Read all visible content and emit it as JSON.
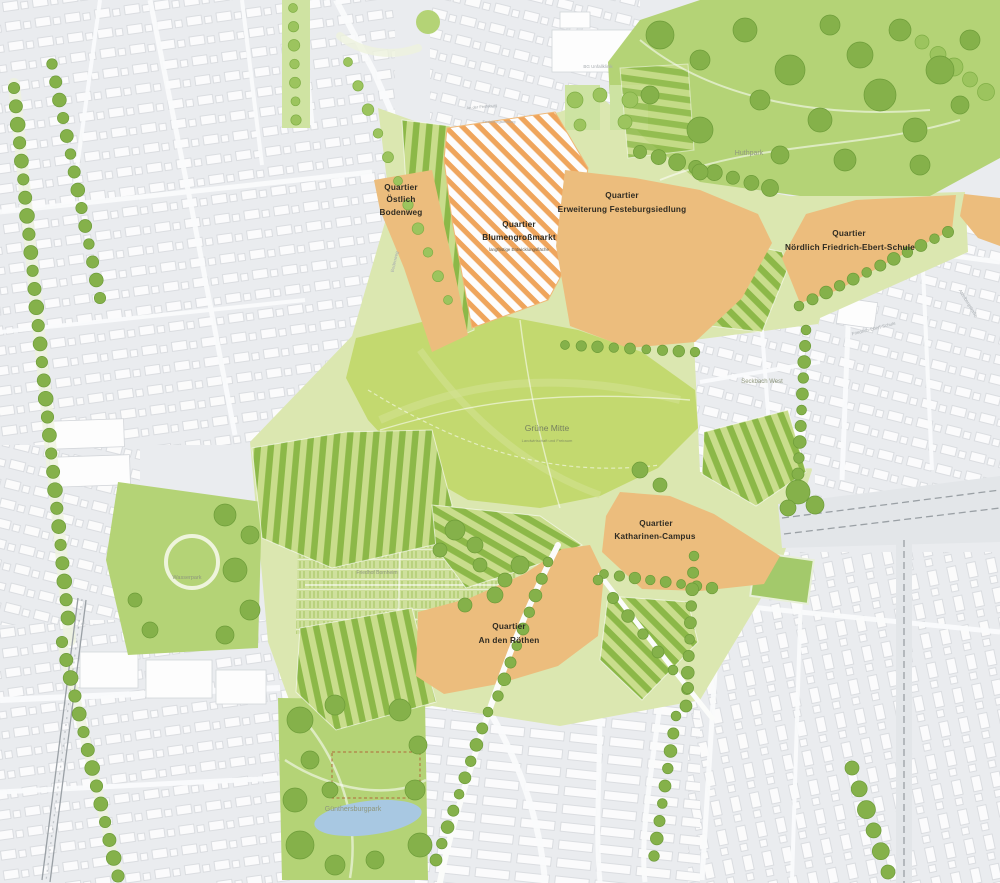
{
  "map": {
    "title": "Masterplan Grüne Mitte — Quartiersplan",
    "quarters": [
      {
        "id": "oestlich-bodenweg",
        "line1": "Quartier",
        "line2": "Östlich",
        "line3": "Bodenweg"
      },
      {
        "id": "blumengrossmarkt",
        "line1": "Quartier",
        "line2": "Blumengroßmarkt",
        "subtitle": "langfristige Entwicklungsfläche"
      },
      {
        "id": "erweiterung-festeburgsiedlung",
        "line1": "Quartier",
        "line2": "Erweiterung Festeburgsiedlung"
      },
      {
        "id": "noerdlich-friedrich-ebert-schule",
        "line1": "Quartier",
        "line2": "Nördlich Friedrich-Ebert-Schule"
      },
      {
        "id": "katharinen-campus",
        "line1": "Quartier",
        "line2": "Katharinen-Campus"
      },
      {
        "id": "an-den-roethen",
        "line1": "Quartier",
        "line2": "An den Röthen"
      }
    ],
    "places": {
      "huthpark": "Huthpark",
      "guenthersburgpark": "Günthersburgpark",
      "wasserpark": "Wasserpark",
      "friedhof": "Friedhof Bornheim",
      "gruene_mitte": "Grüne Mitte",
      "gruene_mitte_sub": "Landwirtschaft und Freiraum",
      "seckbach_west": "Seckbach West",
      "bg_unfallklinik": "BG Unfallklinik",
      "friedrich_ebert_schule": "Friedrich-Ebert-Schule",
      "an_der_festeburg": "An der Festeburg",
      "festeburgsiedlung": "Festeburgsiedlung",
      "bodenweg": "Bodenweg",
      "atzelbergstrasse": "Atzelbergstraße"
    },
    "colors": {
      "quarter_fill": "#ecbd7d",
      "hatch_stripe": "#efa55c",
      "park_green": "#b4d376",
      "belt_green": "#dbe7b0",
      "field_green": "#c3d96f",
      "stripe_dark": "#8cb848",
      "stripe_light": "#c9dd8c",
      "tree_green": "#85b14a",
      "pond_blue": "#a8c8e2",
      "urban_bg": "#eaecef",
      "building_white": "#fdfdfd",
      "rail_gray": "#9aa0a5",
      "label_dark": "#2f2b22",
      "label_gray": "#8f977d"
    }
  }
}
